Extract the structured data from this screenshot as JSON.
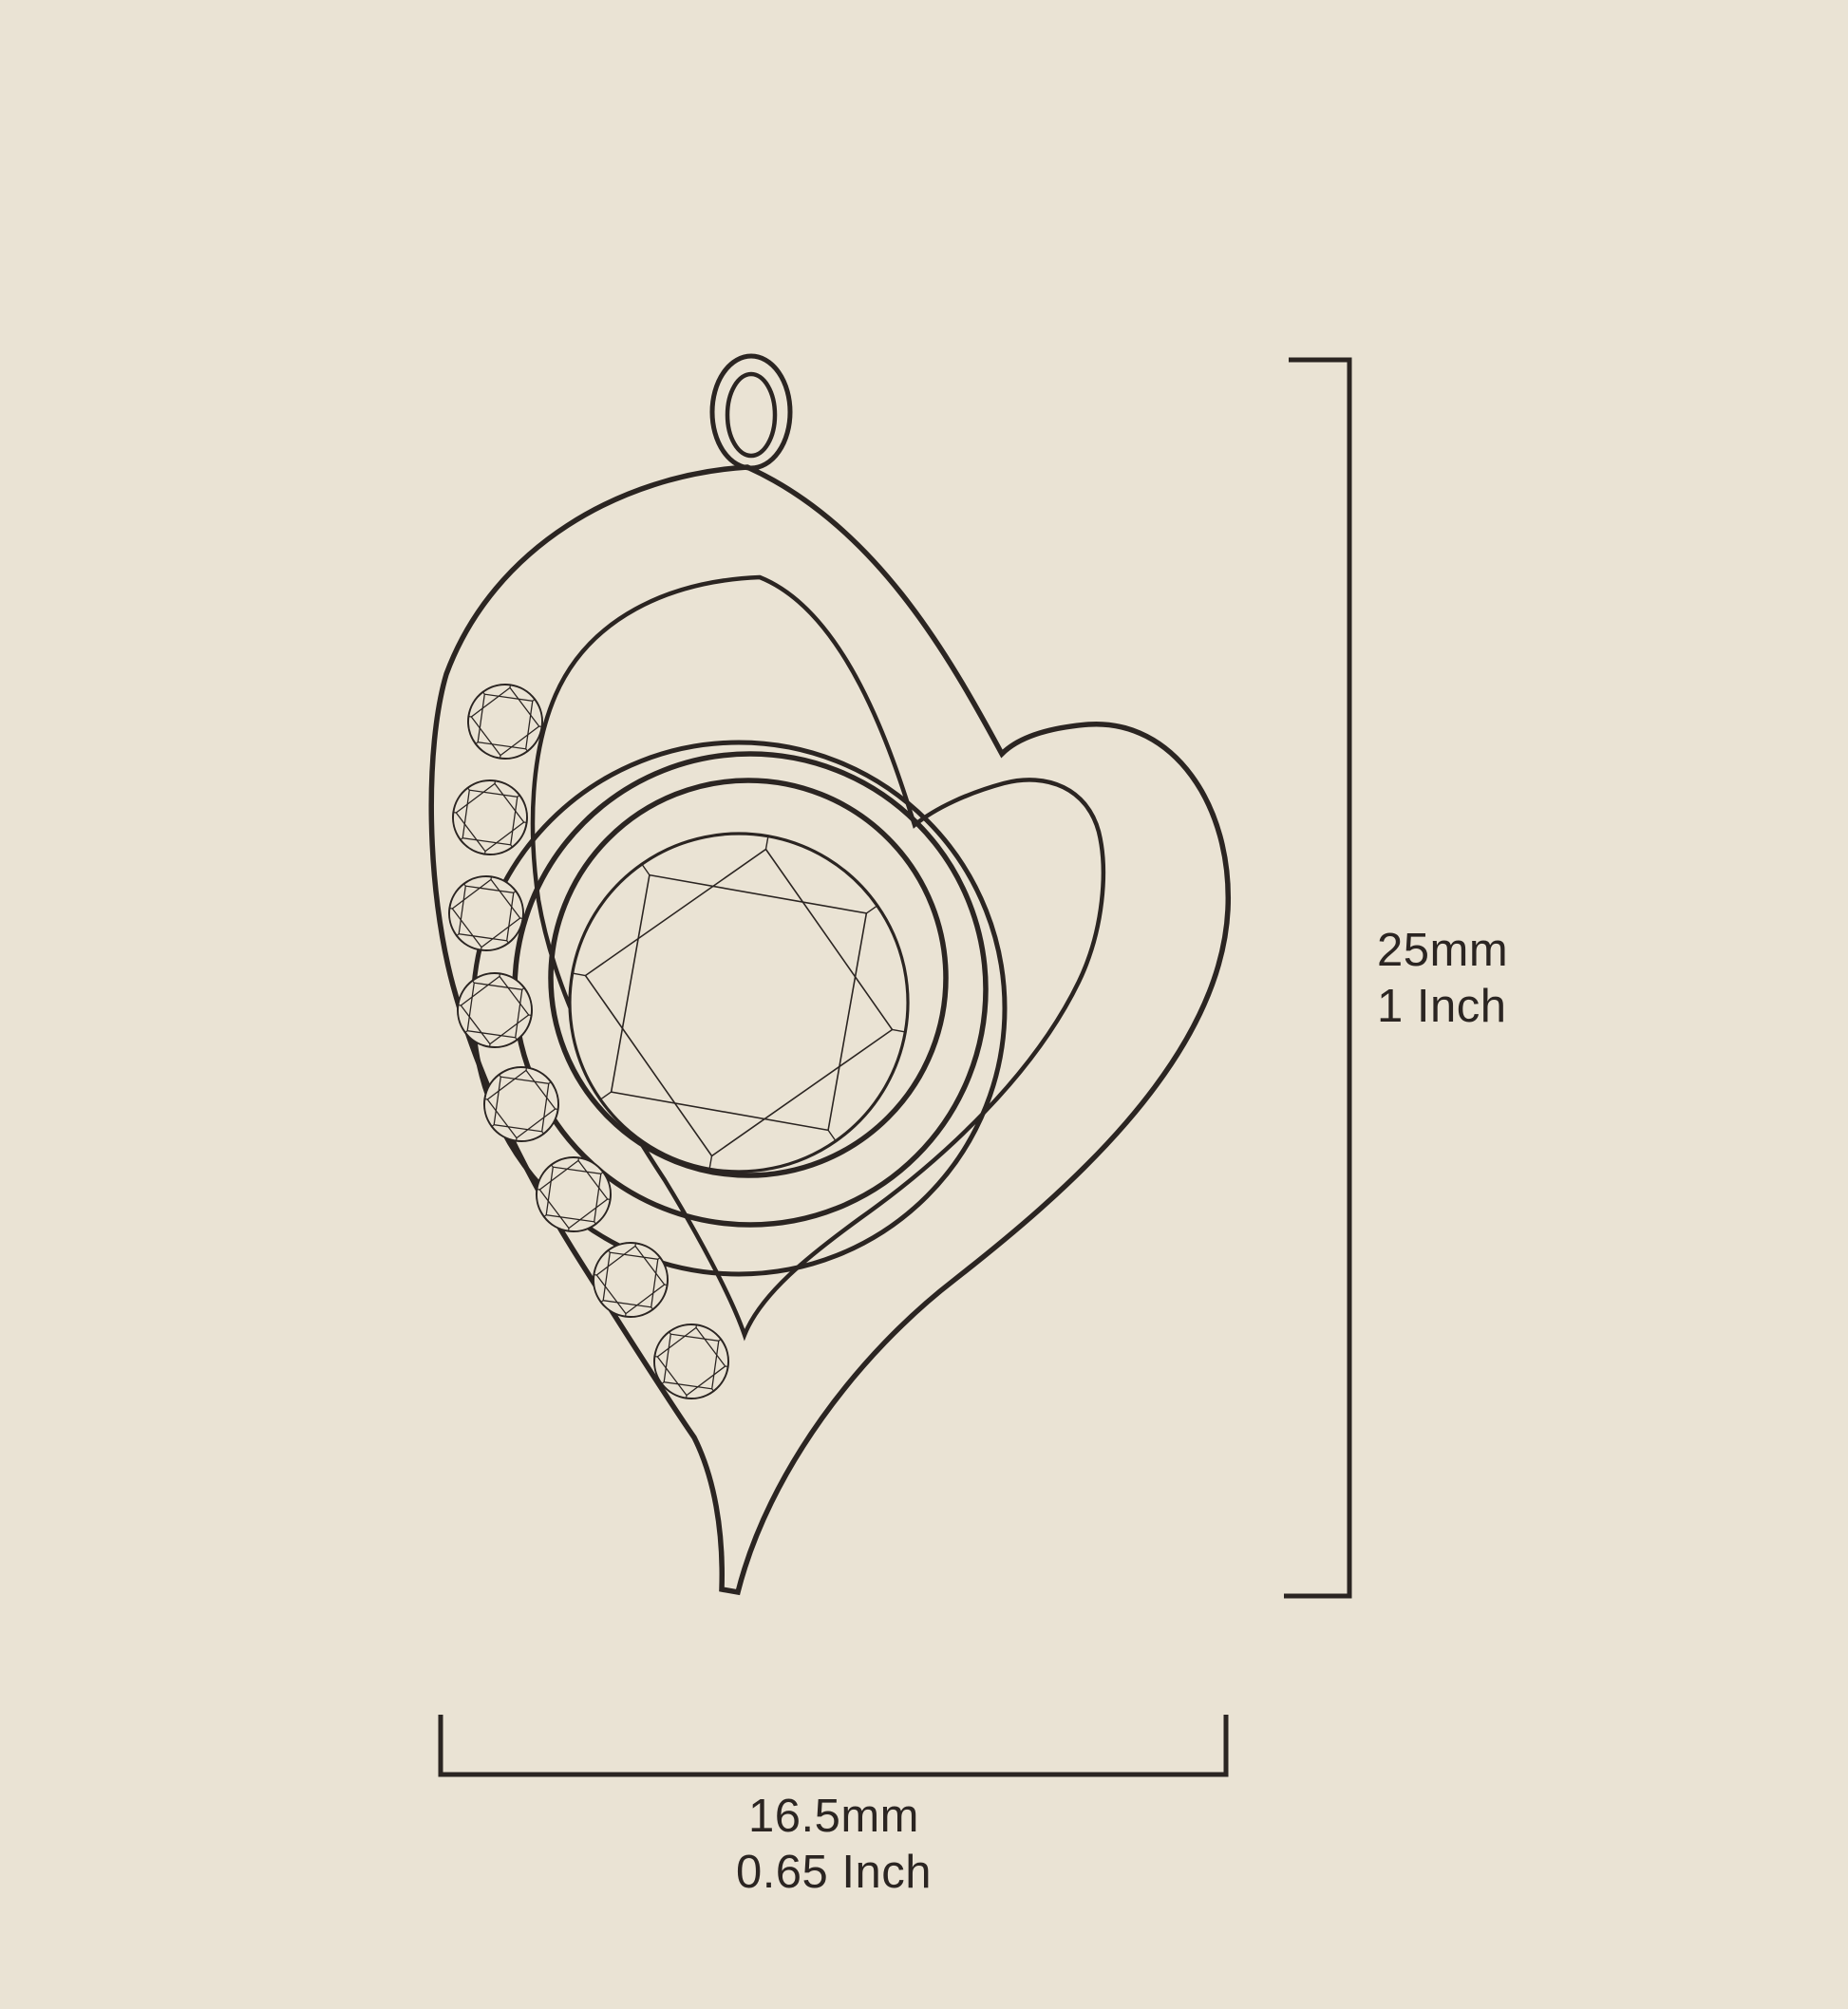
{
  "canvas": {
    "background_color": "#EAE3D4",
    "ink_color": "#2B2522"
  },
  "illustration": {
    "subject": "Heart-shaped pendant technical line drawing",
    "bail": "oval jump ring",
    "center_stone": "round brilliant-cut gemstone in circular bezel",
    "accent_stones_count": 8
  },
  "dimensions": {
    "height": {
      "metric": "25mm",
      "imperial": "1 Inch"
    },
    "width": {
      "metric": "16.5mm",
      "imperial": "0.65 Inch"
    }
  }
}
